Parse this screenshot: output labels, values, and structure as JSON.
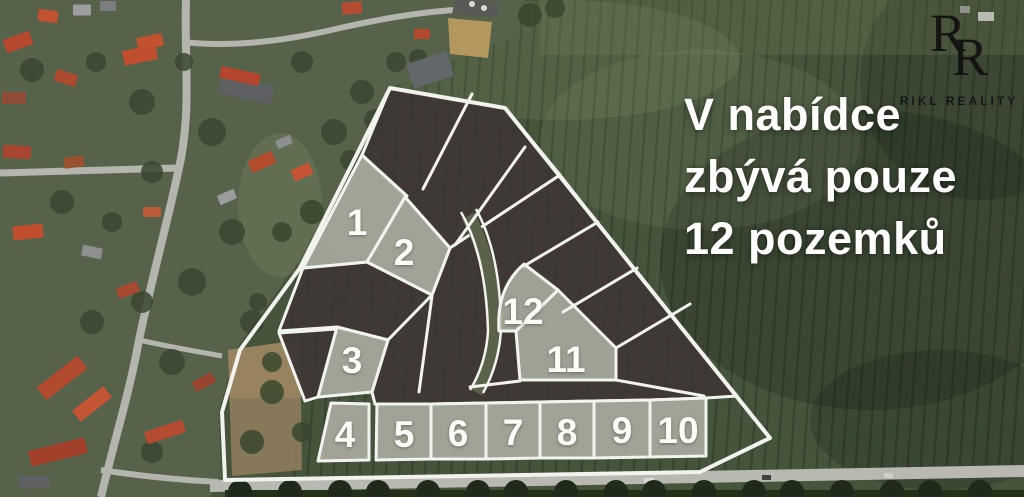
{
  "branding": {
    "monogram_top": "R",
    "monogram_bottom": "R",
    "company": "RIKL REALITY"
  },
  "headline": {
    "line1": "V nabídce",
    "line2": "zbývá pouze",
    "line3": "12 pozemků"
  },
  "map": {
    "available_count": 12,
    "colors": {
      "plot_line": "#F2F3EE",
      "sold_fill": "#3E3734",
      "available_fill": "#A6AA9D",
      "label_text": "#FCFCF9",
      "headline_text": "#FFFFFF",
      "logo_text": "#1A1A1A"
    },
    "outline_points": "390,88 505,108 770,438 700,472 225,480 222,412 240,350 300,268",
    "sold_parcels": [
      {
        "points": "390,88 505,108 560,175 450,248 405,197 362,155"
      },
      {
        "points": "303,268 367,262 432,295 388,340 337,327 279,331"
      },
      {
        "points": "279,333 337,329 318,397 305,401"
      },
      {
        "points": "560,175 628,262 737,396 706,398 650,400 594,401 431,404 375,404 372,392 388,340 432,295 450,248"
      }
    ],
    "available_plots": [
      {
        "n": "1",
        "points": "362,155 407,196 367,262 303,268",
        "lx": 357,
        "ly": 222
      },
      {
        "n": "2",
        "points": "405,197 450,248 432,295 367,262",
        "lx": 404,
        "ly": 252
      },
      {
        "n": "3",
        "points": "337,327 388,340 372,392 318,397",
        "lx": 352,
        "ly": 360
      },
      {
        "n": "4",
        "points": "331,403 369,404 369,460 318,461",
        "lx": 345,
        "ly": 434
      },
      {
        "n": "5",
        "points": "377,404 431,404 431,459 376,460",
        "lx": 404,
        "ly": 434
      },
      {
        "n": "6",
        "points": "431,404 486,403 486,459 431,459",
        "lx": 458,
        "ly": 433
      },
      {
        "n": "7",
        "points": "486,403 540,402 540,458 486,459",
        "lx": 513,
        "ly": 432
      },
      {
        "n": "8",
        "points": "540,402 594,401 594,458 540,458",
        "lx": 567,
        "ly": 432
      },
      {
        "n": "9",
        "points": "594,401 650,400 650,457 594,458",
        "lx": 622,
        "ly": 430
      },
      {
        "n": "10",
        "points": "650,400 706,398 706,456 650,457",
        "lx": 678,
        "ly": 430
      },
      {
        "n": "11",
        "points": "516,331 558,290 616,348 616,380 520,380",
        "lx": 566,
        "ly": 359
      },
      {
        "n": "12",
        "path": "M 524,264 Q 496,288 499,331 L 516,331 L 558,290 Z",
        "lx": 523,
        "ly": 311
      }
    ],
    "divider_lines": [
      "M472,94 L423,189",
      "M525,147 L455,245",
      "M524,266 L598,222",
      "M563,312 L637,268",
      "M616,348 L690,304",
      "M432,296 L419,392",
      "M616,380 L704,396",
      "M470,387 L520,381"
    ],
    "road_center": "M 468,216 Q 492,258 494,330 Q 492,365 476,392",
    "road_edges": [
      "M 461,212 Q 486,256 488,331 Q 486,364 470,390",
      "M 476,209 Q 501,255 501,330 Q 499,364 483,393"
    ]
  }
}
